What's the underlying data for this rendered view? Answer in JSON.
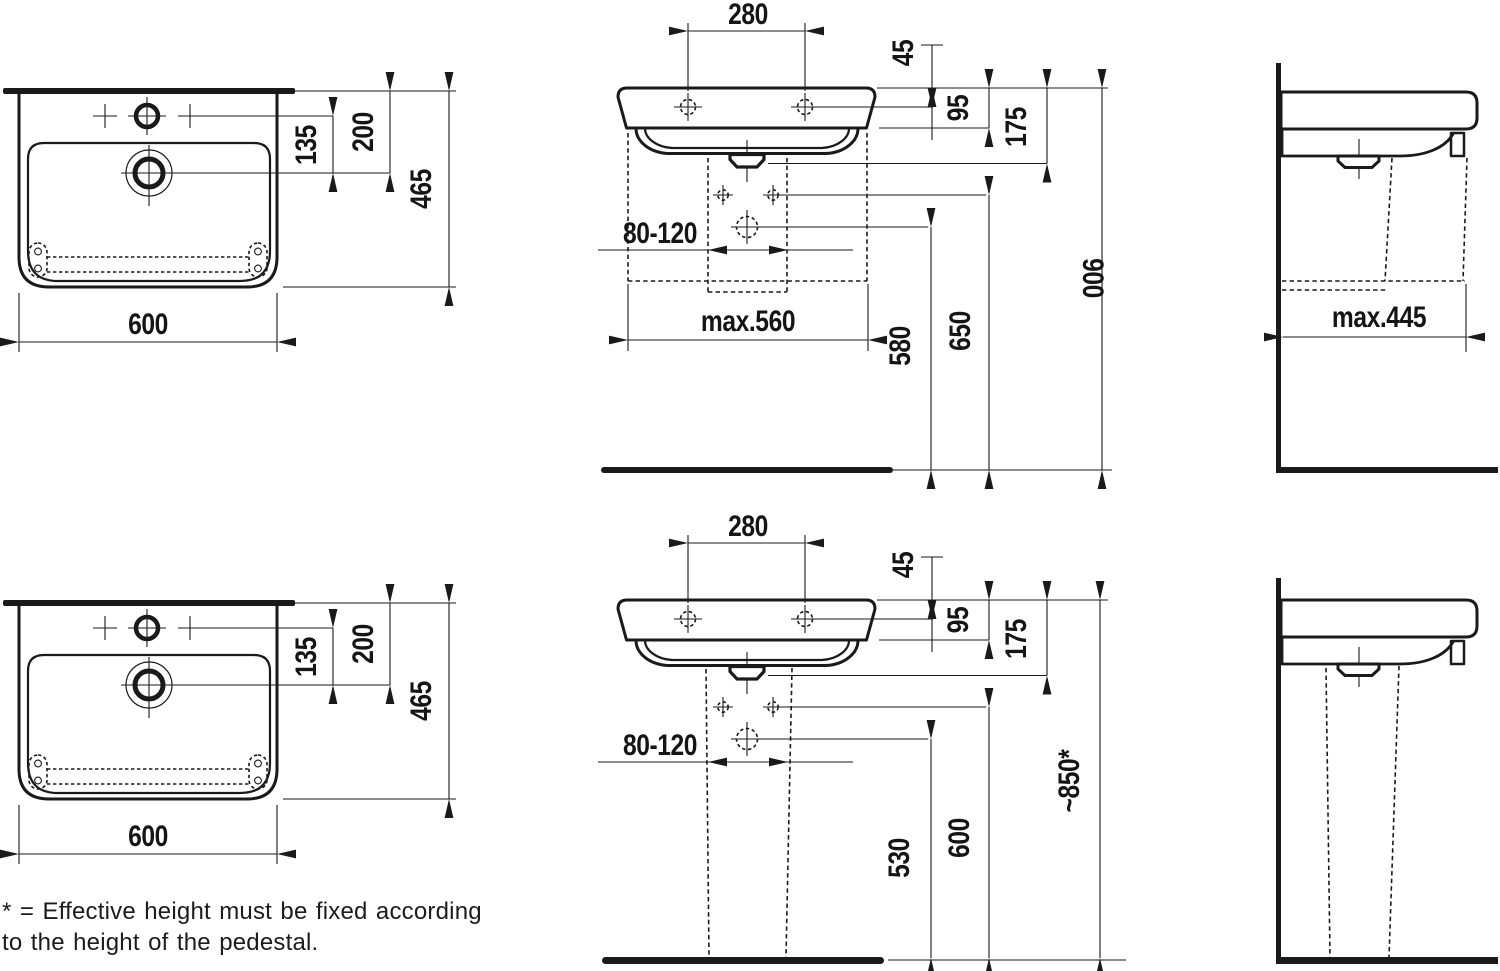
{
  "colors": {
    "ink": "#1a1a1a",
    "background": "#ffffff"
  },
  "labels": {
    "plan": {
      "width": "600",
      "depth": "465",
      "tap_to_drain": "135",
      "wall_to_drain": "200"
    },
    "front": {
      "tap_hole_spacing": "280",
      "rim_to_fixing": "45",
      "fixing_to_underside": "95",
      "basin_height": "175",
      "drain_offset_range": "80-120"
    },
    "front_wall": {
      "max_cabinet_width": "max.560",
      "floor_to_drain": "580",
      "floor_to_fixing": "650",
      "floor_to_rim": "900"
    },
    "front_pedestal": {
      "floor_to_drain": "530",
      "floor_to_fixing": "600",
      "floor_to_rim": "~850*"
    },
    "side_wall": {
      "max_depth": "max.445"
    }
  },
  "footnote": {
    "line1": "* = Effective height must be fixed according",
    "line2": "to the height of the pedestal."
  }
}
